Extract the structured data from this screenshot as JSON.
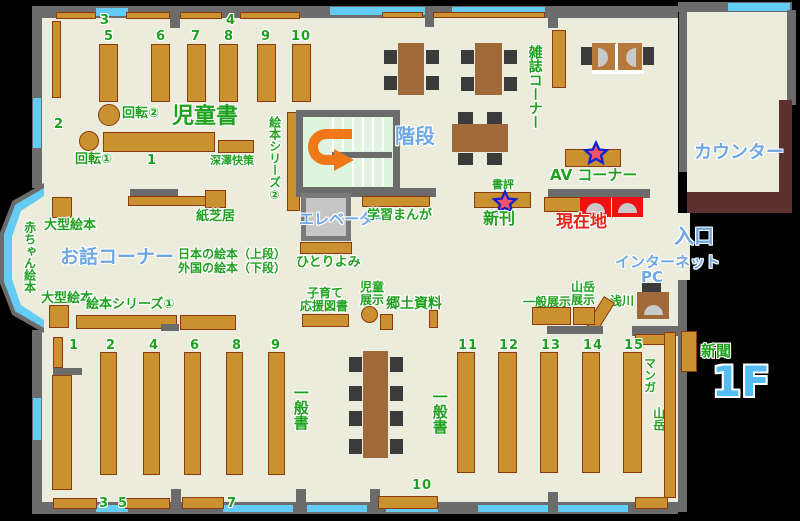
{
  "floor_label": "1F",
  "colors": {
    "floor": "#ECECDD",
    "wall": "#6B6B6B",
    "window": "#63CBF4",
    "shelf": "#C9912F",
    "shelf_border": "#8E3A0F",
    "table": "#A0693A",
    "chair": "#3B3B3B",
    "counter": "#5E3130",
    "stairs_bg": "#DFF3DF",
    "green_label": "#1FA11F",
    "blue_label": "#6FA7E3",
    "red_label": "#E8241A",
    "arrow_orange": "#F07818",
    "highlight_red": "#EE1111",
    "star_fill": "#F2556B",
    "star_stroke": "#1520CE"
  },
  "areas": {
    "children_books": "児童書",
    "story_corner": "お話コーナー",
    "magazine_corner": "雑誌コーナー",
    "av_corner": "AV コーナー",
    "counter": "カウンター",
    "stairs": "階段",
    "elevator": "エレベーター",
    "entrance": "入口",
    "internet_line1": "インターネット",
    "internet_line2": "PC",
    "you_are_here": "現在地",
    "general_books_left": "一般書",
    "general_books_right": "一般書",
    "local_materials": "郷土資料",
    "newspaper": "新聞"
  },
  "labels": {
    "rotation1": "回転①",
    "rotation2": "回転②",
    "fukazawa_kaisaku": "深澤快策",
    "picture_book_series1": "絵本シリーズ①",
    "picture_book_series2": "絵本シリーズ②",
    "kamishibai": "紙芝居",
    "large_picture_books_top": "大型絵本",
    "large_picture_books_bottom": "大型絵本",
    "baby_picture_books": "赤ちゃん絵本",
    "japanese_picture_books": "日本の絵本（上段）",
    "foreign_picture_books": "外国の絵本（下段）",
    "solo_reading": "ひとりよみ",
    "study_manga": "学習まんが",
    "parenting_line1": "子育て",
    "parenting_line2": "応援図書",
    "children_display_line1": "児童",
    "children_display_line2": "展示",
    "book_review": "書評",
    "new_arrivals": "新刊",
    "general_display": "一般展示",
    "mountain_display_line1": "山岳",
    "mountain_display_line2": "展示",
    "asakawa": "浅川",
    "manga": "マンガ",
    "mountain": "山岳"
  },
  "numbers": {
    "children_top": [
      "3",
      "4"
    ],
    "children_left": "2",
    "children_columns": [
      "5",
      "6",
      "7",
      "8",
      "9",
      "10"
    ],
    "children_row": "1",
    "general_left_columns": [
      "1",
      "2",
      "4",
      "6",
      "8",
      "9"
    ],
    "general_right_columns": [
      "11",
      "12",
      "13",
      "14",
      "15"
    ],
    "general_bottom": [
      "3",
      "5",
      "7",
      "10"
    ]
  }
}
